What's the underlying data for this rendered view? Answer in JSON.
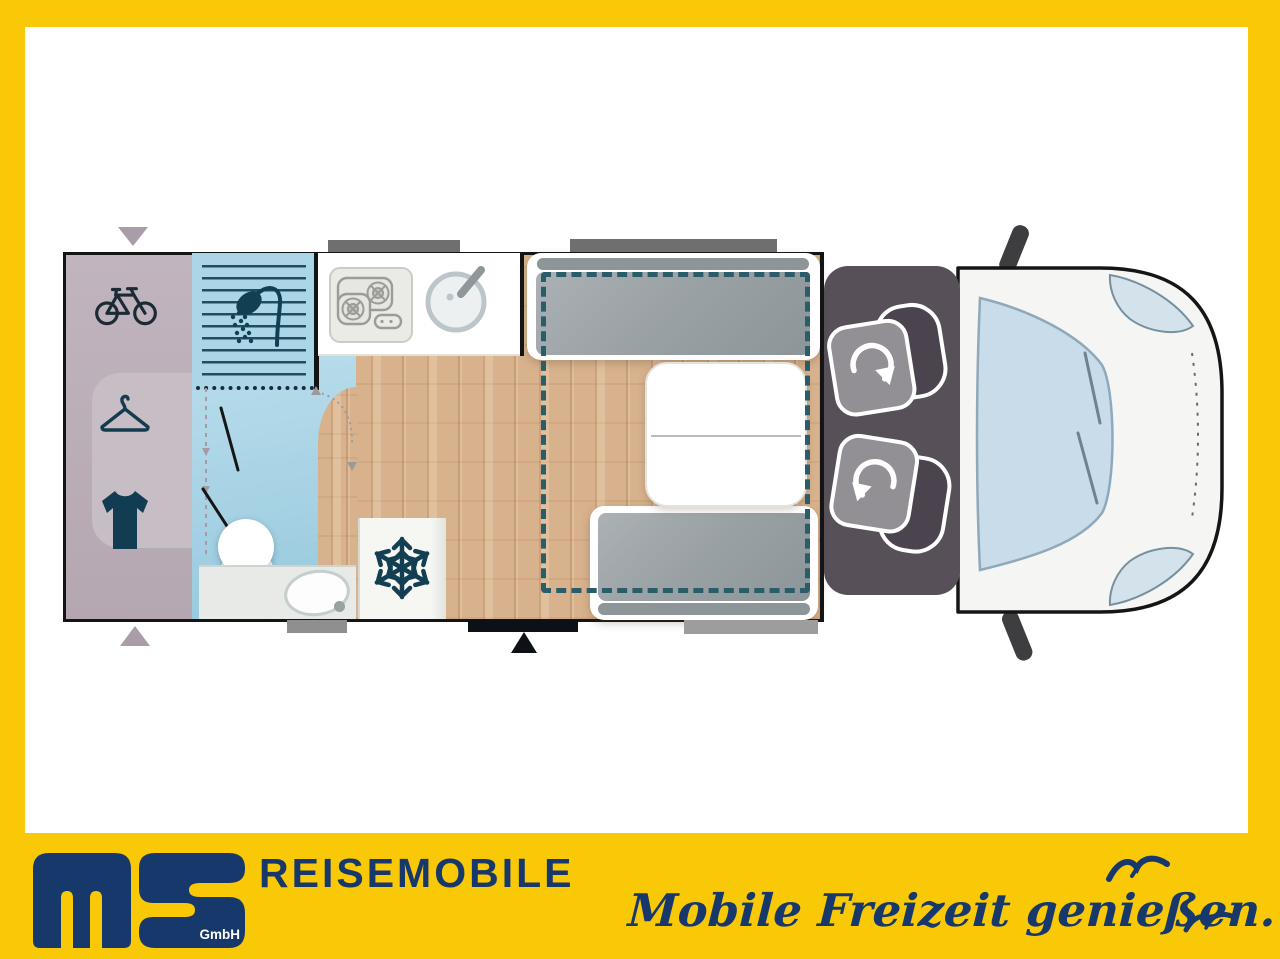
{
  "branding": {
    "logo_text": "ms",
    "logo_sub": "GmbH",
    "company_type": "REISEMOBILE",
    "slogan": "Mobile Freizeit genießen.",
    "colors": {
      "yellow": "#F9C806",
      "navy": "#17386A"
    }
  },
  "floorplan": {
    "type": "motorhome-top-view-layout",
    "colors": {
      "garage": "#BCB0BA",
      "bathroom": "#A6D2E4",
      "wood_floor": "#D8B28D",
      "cushion": "#9BA2A6",
      "cab_floor": "#575059",
      "bed_outline_dash": "#2A5C6A",
      "wall": "#141414",
      "windshield": "#C9DCE9"
    },
    "rooms": [
      {
        "name": "rear-garage",
        "icons": [
          "bicycle-icon",
          "hanger-icon",
          "shirt-icon"
        ]
      },
      {
        "name": "bathroom",
        "icons": [
          "shower-icon"
        ],
        "fixtures": [
          "shower-stall",
          "toilet",
          "washbasin"
        ]
      },
      {
        "name": "kitchen",
        "fixtures": [
          "two-burner-hob",
          "round-sink"
        ]
      },
      {
        "name": "fridge-cabinet",
        "icons": [
          "snowflake-icon"
        ]
      },
      {
        "name": "dinette",
        "fixtures": [
          "bench-seat-front",
          "bench-seat-rear",
          "table",
          "drop-down-bed-outline"
        ]
      },
      {
        "name": "cab",
        "fixtures": [
          "swivel-seat-driver",
          "swivel-seat-passenger"
        ],
        "icons": [
          "rotate-arrow-icon",
          "rotate-arrow-icon"
        ]
      }
    ],
    "markers": [
      "entry-door-marker",
      "entry-arrow",
      "garage-access-arrow-top",
      "garage-access-arrow-bottom",
      "window-markers"
    ]
  }
}
